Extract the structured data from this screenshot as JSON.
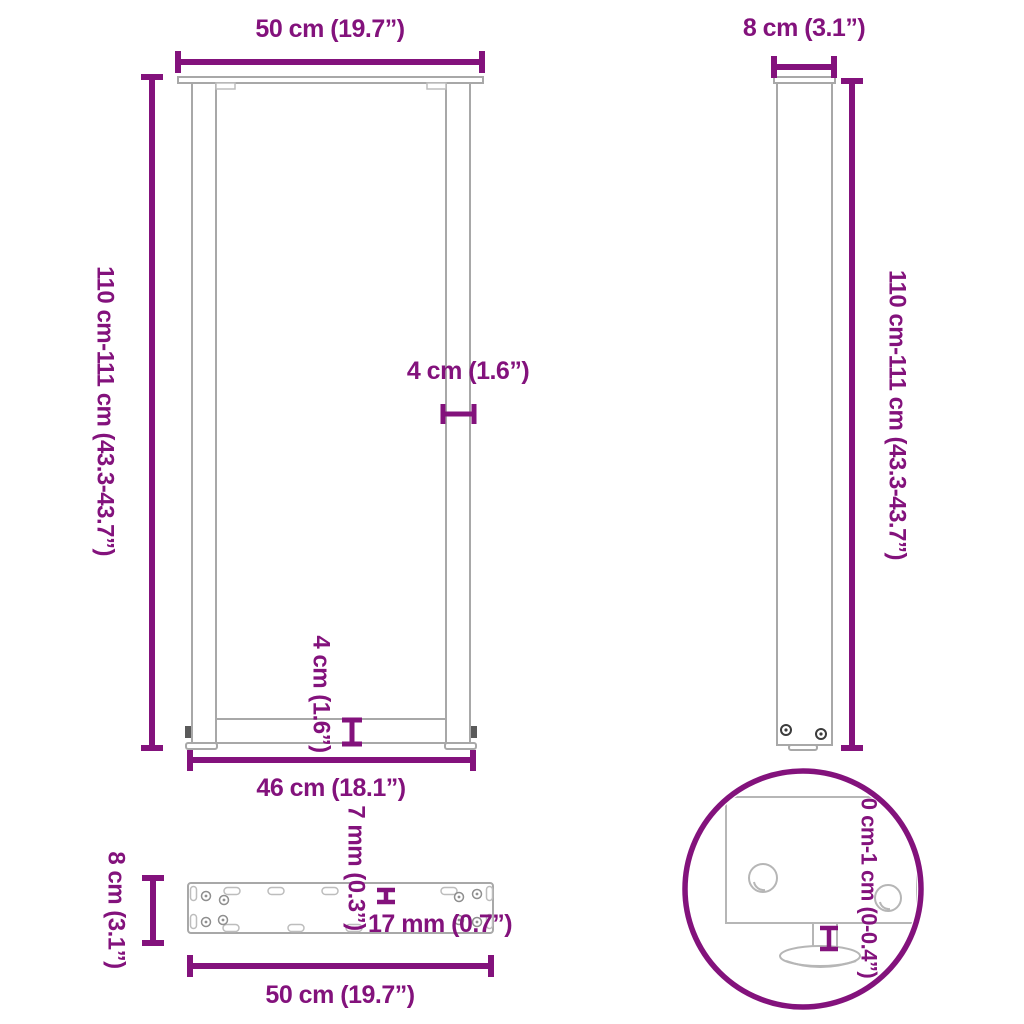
{
  "colors": {
    "accent": "#83127c",
    "drawing_line": "#a8a8a8"
  },
  "views": {
    "front": {
      "title": "front-view-of-u-shaped-table-leg",
      "dim_width_top": "50 cm (19.7”)",
      "dim_height_left": "110 cm-111 cm (43.3-43.7”)",
      "dim_bar_width": "4 cm (1.6”)",
      "dim_crossbar_height": "4 cm (1.6”)",
      "dim_width_bottom": "46 cm (18.1”)"
    },
    "side": {
      "title": "side-view-of-table-leg",
      "dim_width_top": "8 cm (3.1”)",
      "dim_height_right": "110 cm-111 cm (43.3-43.7”)"
    },
    "plate": {
      "title": "top-view-of-mounting-plate",
      "dim_height_left": "8 cm (3.1”)",
      "dim_width_bottom": "50 cm (19.7”)",
      "dim_plate_thickness": "7 mm (0.3”)",
      "dim_hole_spacing": "17 mm (0.7”)"
    },
    "detail": {
      "title": "detail-view-adjustable-foot",
      "dim_foot_adjustment": "0 cm-1 cm (0-0.4”)"
    }
  }
}
